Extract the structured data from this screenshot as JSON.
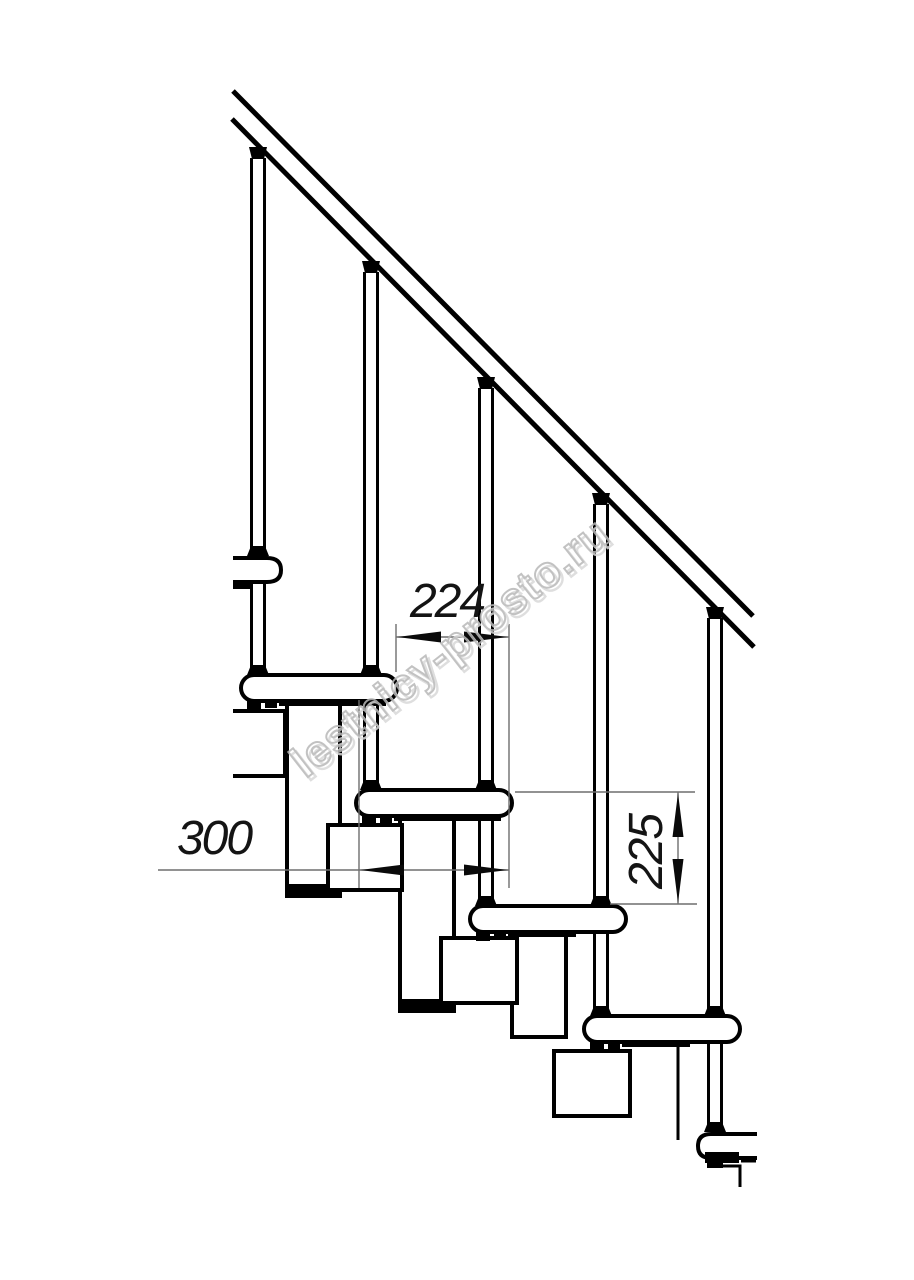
{
  "drawing": {
    "watermark": {
      "text": "lestnicy-prosto.ru"
    },
    "dimensions": {
      "step_going": {
        "label": "224"
      },
      "tread_depth": {
        "label": "300"
      },
      "step_rise": {
        "label": "225"
      }
    },
    "colors": {
      "line": "#000000",
      "dimension_line": "#6e6e6e",
      "watermark": "#bdbdbd",
      "background": "#ffffff"
    }
  }
}
